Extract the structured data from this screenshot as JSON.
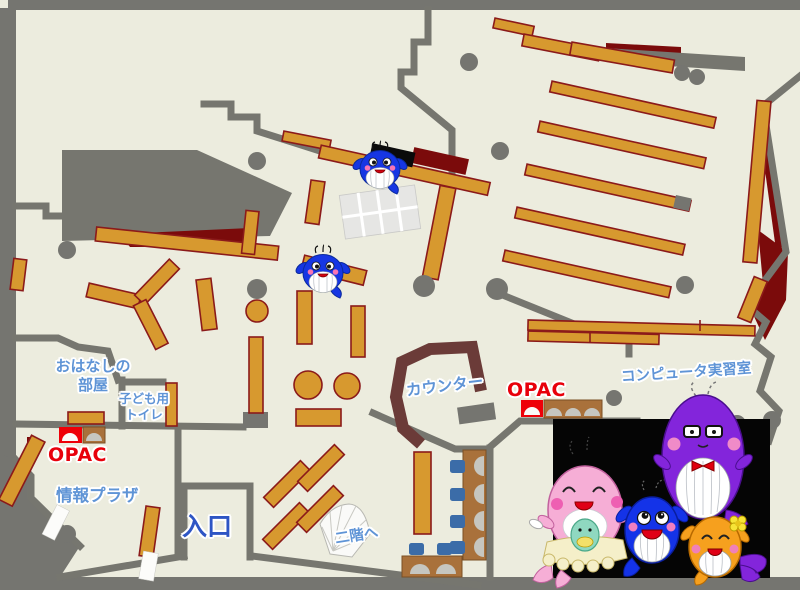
{
  "title": "図書館フロアマップ",
  "labels": {
    "story_room_1": "おはなしの",
    "story_room_2": "部屋",
    "kids_toilet_1": "子ども用",
    "kids_toilet_2": "トイレ",
    "opac_left": "OPAC",
    "opac_right": "OPAC",
    "info_plaza": "情報プラザ",
    "entrance": "入口",
    "counter": "カウンター",
    "computer_room": "コンピュータ実習室",
    "to_second_floor": "二階へ"
  },
  "mascots": {
    "on_map_small_blue_whales": 2,
    "panel_group": [
      "pink-whale-with-baby",
      "blue-whale",
      "purple-whale-glasses-bow",
      "orange-whale-flower"
    ]
  },
  "colors": {
    "floor": "#ECECDE",
    "wall": "#76766F",
    "shelf": "#D7992F",
    "shelf_border": "#8B1A1A",
    "dark_red_area": "#7B0B0B",
    "counter_wood": "#6B3B38",
    "label_blue": "#5F94D6",
    "entrance_blue": "#2E55C4",
    "opac_red": "#E8000B",
    "desk_brown": "#A9713B",
    "chair_blue": "#3B6CA8",
    "panel_black": "#050505",
    "mascot_blue": "#1636E3",
    "mascot_pink": "#F6AED6",
    "mascot_purple": "#8325DB",
    "mascot_orange": "#F6A01E"
  }
}
